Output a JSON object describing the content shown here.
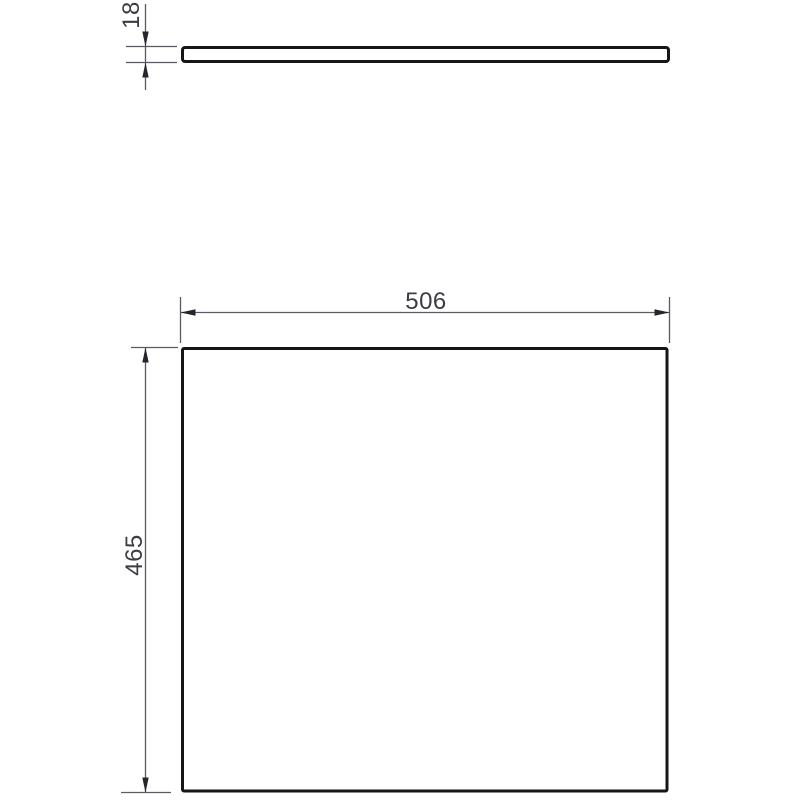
{
  "drawing": {
    "kind": "technical-dimension-drawing",
    "dimensions": {
      "thickness": "18",
      "width": "506",
      "height": "465"
    },
    "colors": {
      "background": "#ffffff",
      "part_outline": "#161616",
      "part_fill": "#ffffff",
      "dimension_line": "#5a5a62",
      "arrowhead": "#25252b",
      "dimension_text": "#3c3c46"
    }
  }
}
